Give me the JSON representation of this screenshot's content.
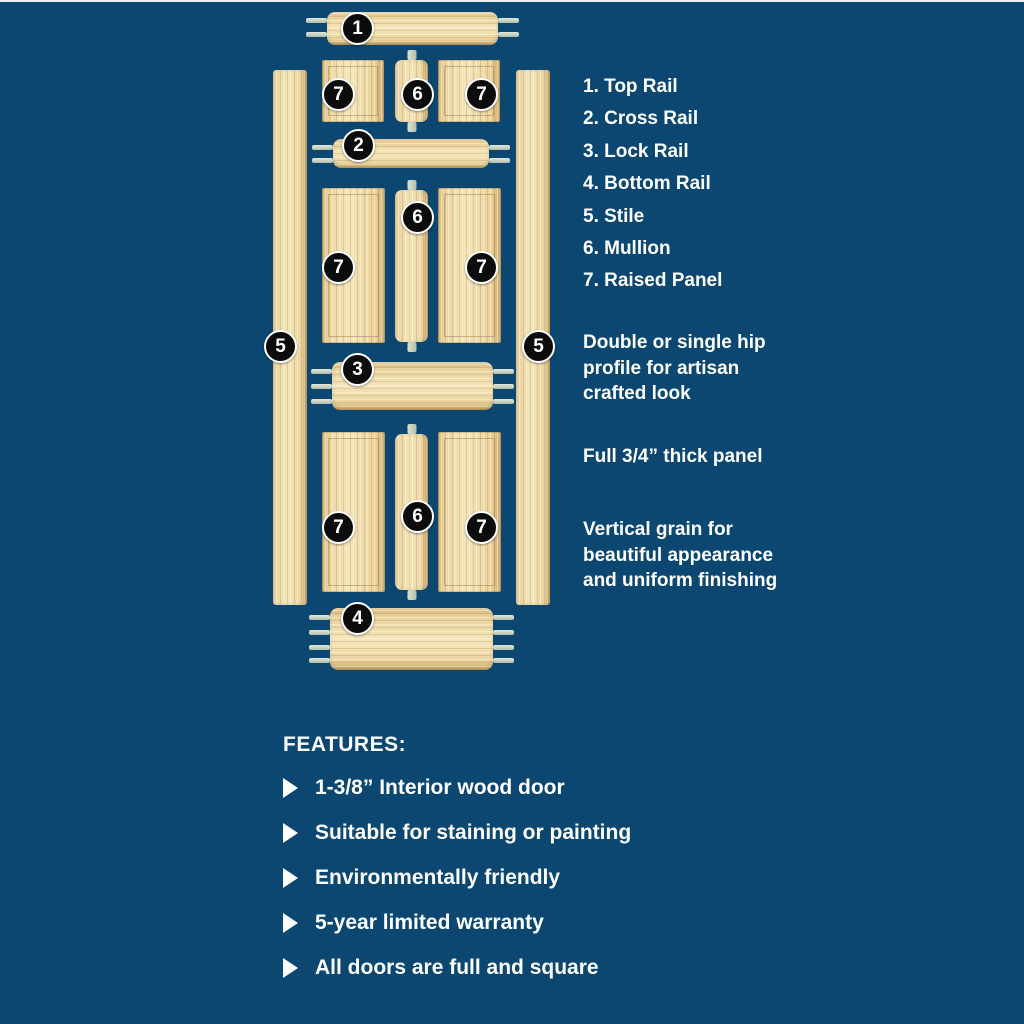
{
  "colors": {
    "background": "#0b4770",
    "wood": "#ecd6a2",
    "tenon": "#c5cfc0",
    "badge_fill": "#0c0c0c",
    "text": "#ffffff"
  },
  "diagram": {
    "badges": {
      "top_rail": "1",
      "cross_rail": "2",
      "lock_rail": "3",
      "bottom_rail": "4",
      "stile": "5",
      "mullion": "6",
      "raised_panel": "7"
    }
  },
  "legend": {
    "items": [
      {
        "label": "1. Top Rail"
      },
      {
        "label": "2. Cross Rail"
      },
      {
        "label": "3. Lock Rail"
      },
      {
        "label": "4. Bottom Rail"
      },
      {
        "label": "5. Stile"
      },
      {
        "label": "6. Mullion"
      },
      {
        "label": "7. Raised Panel"
      }
    ]
  },
  "notes": {
    "hip_profile": [
      "Double or single hip",
      "profile for artisan",
      "crafted look"
    ],
    "panel_thickness": [
      "Full 3/4” thick panel"
    ],
    "grain": [
      "Vertical grain for",
      "beautiful appearance",
      "and uniform finishing"
    ]
  },
  "features": {
    "heading": "FEATURES:",
    "items": [
      {
        "label": "1-3/8” Interior wood door"
      },
      {
        "label": "Suitable for staining or painting"
      },
      {
        "label": "Environmentally friendly"
      },
      {
        "label": "5-year limited warranty"
      },
      {
        "label": "All doors are full and square"
      }
    ]
  }
}
